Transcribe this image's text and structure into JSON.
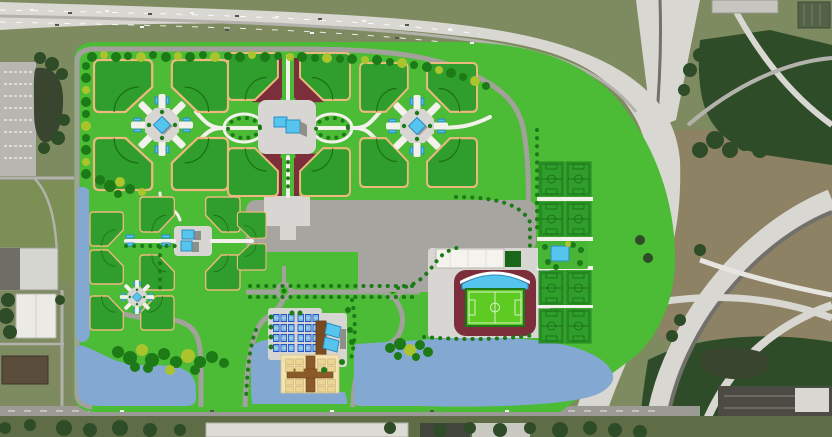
{
  "meta": {
    "view": "aerial-site-plan-rendering",
    "subject": "sports-complex-master-plan",
    "no_visible_text": true
  },
  "colors": {
    "aerial_olive": "#7e8a5f",
    "aerial_grass": "#7c9055",
    "aerial_tree": "#2f4c28",
    "scrub": "#8d8263",
    "highway_light": "#d8d7d2",
    "highway_mid": "#b3b2ac",
    "asphalt": "#71706a",
    "warehouse": "#d6d6d0",
    "pond_dark": "#39452f",
    "site_green": "#4cbb35",
    "field_green": "#2f9e2c",
    "field_border": "#eeb97f",
    "field_line": "#145c10",
    "road_gray": "#a2a19c",
    "parking_gray": "#a6a5a0",
    "plaza_gray": "#d7d6d2",
    "path_white": "#f2f1ec",
    "maroon": "#7c2f3a",
    "pond_blue": "#83a9d2",
    "building_blue": "#56c5ee",
    "building_blue_dark": "#2c8cc0",
    "shadow_gray": "#8f8f8a",
    "stadium_pitch": "#5ecb22",
    "white_bldg": "#f4f3ee",
    "tan_pad": "#f3e2b2",
    "cabana_tan": "#ead592",
    "cabana_line": "#c9ae74",
    "brown": "#8a5a28",
    "hotel_brown": "#7a4a22",
    "court_blue": "#2a52c8",
    "court_inner": "#7fc0e8",
    "tree_dark": "#1c7a17",
    "tree_lime": "#a9c42d"
  },
  "features": {
    "counts": {
      "diamond_field_clusters": 4,
      "diamond_fields": 22,
      "rectangular_pitches": 8,
      "stadium": 1,
      "courts": 24,
      "cabanas": 16,
      "roundabouts": 2,
      "ponds": 4
    },
    "instances": [
      {
        "symbol": "sym-ballfield",
        "layer": "layer-ballfields",
        "name": "ball-field",
        "transforms": [
          "translate(94,60) scale(1.12,1.13)",
          "translate(228,60) scale(-1.08,1.13)",
          "translate(94,190) scale(1.12,-1.13)",
          "translate(228,190) scale(-1.08,-1.13)",
          "translate(228,53) scale(0.96,1.02)",
          "translate(350,53) scale(-0.96,1.02)",
          "translate(228,196) scale(0.96,-1.04)",
          "translate(350,196) scale(-0.96,-1.04)",
          "translate(360,63) scale(0.92,1.06)",
          "translate(477,63) scale(-0.96,1.06)",
          "translate(360,187) scale(0.92,-1.06)",
          "translate(477,187) scale(-0.96,-1.06)",
          "translate(140,197) scale(0.66,0.76)",
          "translate(240,197) scale(-0.66,0.76)",
          "translate(90,212) scale(0.64,0.74)",
          "translate(90,284) scale(0.64,-0.74)",
          "translate(140,290) scale(0.66,-0.76)",
          "translate(240,290) scale(-0.66,-0.76)",
          "translate(266,212) scale(-0.55,0.57)",
          "translate(266,270) scale(-0.55,-0.57)",
          "translate(90,330) scale(0.64,-0.74)",
          "translate(174,330) scale(-0.64,-0.74)"
        ]
      },
      {
        "symbol": "sym-quadplaza",
        "layer": "layer-plazas",
        "name": "field-cluster-plaza",
        "transforms": [
          "translate(162,125)",
          "translate(417,126)",
          "translate(137,297) scale(0.55)"
        ]
      },
      {
        "symbol": "sym-pitch",
        "layer": "layer-pitches",
        "name": "soccer-pitch",
        "transforms": [
          "translate(539,162)",
          "translate(566,162)",
          "translate(539,202)",
          "translate(566,202)",
          "translate(539,271)",
          "translate(566,271)",
          "translate(539,309)",
          "translate(566,309)"
        ]
      },
      {
        "symbol": "sym-court",
        "layer": "layer-courts",
        "name": "tennis-court",
        "transforms": [
          "translate(273,314)",
          "translate(280.5,314)",
          "translate(288,314)",
          "translate(297.5,314)",
          "translate(305,314)",
          "translate(312.5,314)",
          "translate(273,324)",
          "translate(280.5,324)",
          "translate(288,324)",
          "translate(297.5,324)",
          "translate(305,324)",
          "translate(312.5,324)",
          "translate(273,334)",
          "translate(280.5,334)",
          "translate(288,334)",
          "translate(297.5,334)",
          "translate(305,334)",
          "translate(312.5,334)",
          "translate(273,344)",
          "translate(280.5,344)",
          "translate(288,344)",
          "translate(297.5,344)",
          "translate(305,344)",
          "translate(312.5,344)"
        ]
      },
      {
        "symbol": "sym-cabana",
        "layer": "layer-cabanas",
        "name": "cabana",
        "transforms": [
          "translate(285.5,359)",
          "translate(295.5,359)",
          "translate(285.5,366)",
          "translate(295.5,366)",
          "translate(317.5,359)",
          "translate(327.5,359)",
          "translate(317.5,366)",
          "translate(327.5,366)",
          "translate(285.5,379.5)",
          "translate(295.5,379.5)",
          "translate(285.5,386.5)",
          "translate(295.5,386.5)",
          "translate(317.5,379.5)",
          "translate(327.5,379.5)",
          "translate(317.5,386.5)",
          "translate(327.5,386.5)"
        ]
      }
    ],
    "trees": [
      [
        92,
        57,
        5,
        0
      ],
      [
        104,
        55,
        4,
        1
      ],
      [
        116,
        57,
        5,
        0
      ],
      [
        128,
        56,
        4,
        0
      ],
      [
        141,
        57,
        5,
        1
      ],
      [
        153,
        55,
        4,
        0
      ],
      [
        166,
        57,
        5,
        0
      ],
      [
        178,
        56,
        4,
        1
      ],
      [
        190,
        57,
        5,
        0
      ],
      [
        203,
        55,
        4,
        0
      ],
      [
        215,
        57,
        5,
        1
      ],
      [
        228,
        56,
        4,
        0
      ],
      [
        240,
        57,
        5,
        0
      ],
      [
        252,
        55,
        4,
        1
      ],
      [
        265,
        57,
        5,
        0
      ],
      [
        278,
        56,
        4,
        0
      ],
      [
        290,
        57,
        4,
        1
      ],
      [
        302,
        57,
        5,
        0
      ],
      [
        315,
        58,
        4,
        0
      ],
      [
        327,
        58,
        5,
        1
      ],
      [
        340,
        59,
        4,
        0
      ],
      [
        352,
        59,
        5,
        0
      ],
      [
        365,
        60,
        4,
        1
      ],
      [
        377,
        60,
        5,
        0
      ],
      [
        390,
        62,
        4,
        0
      ],
      [
        402,
        63,
        5,
        1
      ],
      [
        414,
        65,
        4,
        0
      ],
      [
        427,
        67,
        5,
        0
      ],
      [
        439,
        70,
        4,
        1
      ],
      [
        451,
        73,
        5,
        0
      ],
      [
        463,
        77,
        4,
        0
      ],
      [
        475,
        81,
        5,
        1
      ],
      [
        486,
        86,
        4,
        0
      ],
      [
        86,
        66,
        4,
        0
      ],
      [
        86,
        78,
        5,
        0
      ],
      [
        86,
        90,
        4,
        1
      ],
      [
        86,
        102,
        5,
        0
      ],
      [
        86,
        114,
        4,
        0
      ],
      [
        86,
        126,
        5,
        1
      ],
      [
        86,
        138,
        4,
        0
      ],
      [
        86,
        150,
        5,
        0
      ],
      [
        86,
        162,
        4,
        1
      ],
      [
        86,
        174,
        5,
        0
      ],
      [
        100,
        180,
        5,
        0
      ],
      [
        110,
        186,
        6,
        0
      ],
      [
        120,
        182,
        5,
        1
      ],
      [
        130,
        189,
        5,
        0
      ],
      [
        118,
        194,
        4,
        0
      ],
      [
        142,
        192,
        4,
        1
      ],
      [
        118,
        352,
        6,
        0
      ],
      [
        130,
        358,
        7,
        0
      ],
      [
        142,
        350,
        6,
        1
      ],
      [
        152,
        360,
        7,
        0
      ],
      [
        164,
        354,
        6,
        0
      ],
      [
        176,
        362,
        6,
        0
      ],
      [
        188,
        356,
        7,
        1
      ],
      [
        200,
        362,
        6,
        0
      ],
      [
        212,
        357,
        6,
        0
      ],
      [
        224,
        363,
        5,
        0
      ],
      [
        148,
        368,
        5,
        0
      ],
      [
        170,
        370,
        5,
        1
      ],
      [
        195,
        370,
        5,
        0
      ],
      [
        135,
        367,
        5,
        0
      ],
      [
        390,
        348,
        5,
        0
      ],
      [
        400,
        344,
        6,
        0
      ],
      [
        410,
        350,
        6,
        1
      ],
      [
        420,
        345,
        5,
        0
      ],
      [
        428,
        352,
        5,
        0
      ],
      [
        398,
        356,
        4,
        0
      ],
      [
        416,
        357,
        4,
        0
      ],
      [
        545,
        247,
        3,
        0
      ],
      [
        548,
        262,
        3,
        0
      ],
      [
        556,
        267,
        3,
        0
      ],
      [
        573,
        245,
        3,
        0
      ],
      [
        581,
        250,
        3,
        0
      ],
      [
        580,
        263,
        3,
        0
      ],
      [
        568,
        244,
        3,
        1
      ],
      [
        271,
        317,
        2.5,
        0
      ],
      [
        271,
        327,
        2.5,
        0
      ],
      [
        271,
        337,
        2.5,
        0
      ],
      [
        271,
        347,
        2.5,
        0
      ],
      [
        292,
        313,
        2.5,
        0
      ],
      [
        300,
        313,
        2.5,
        0
      ],
      [
        324,
        370,
        3,
        0
      ],
      [
        342,
        362,
        3,
        0
      ],
      [
        350,
        330,
        3,
        0
      ],
      [
        352,
        342,
        3,
        0
      ],
      [
        348,
        310,
        3,
        0
      ],
      [
        40,
        58,
        6,
        2
      ],
      [
        52,
        64,
        7,
        2
      ],
      [
        62,
        74,
        6,
        2
      ],
      [
        64,
        120,
        6,
        2
      ],
      [
        58,
        138,
        7,
        2
      ],
      [
        44,
        148,
        6,
        2
      ],
      [
        8,
        300,
        7,
        2
      ],
      [
        6,
        316,
        8,
        2
      ],
      [
        10,
        332,
        7,
        2
      ],
      [
        60,
        300,
        5,
        2
      ],
      [
        64,
        428,
        8,
        2
      ],
      [
        90,
        430,
        7,
        2
      ],
      [
        120,
        428,
        8,
        2
      ],
      [
        150,
        430,
        7,
        2
      ],
      [
        180,
        430,
        6,
        2
      ],
      [
        390,
        428,
        6,
        2
      ],
      [
        440,
        430,
        7,
        2
      ],
      [
        470,
        428,
        6,
        2
      ],
      [
        500,
        430,
        7,
        2
      ],
      [
        530,
        428,
        6,
        2
      ],
      [
        560,
        430,
        8,
        2
      ],
      [
        590,
        428,
        7,
        2
      ],
      [
        615,
        430,
        7,
        2
      ],
      [
        640,
        432,
        7,
        2
      ],
      [
        30,
        425,
        6,
        2
      ],
      [
        5,
        428,
        6,
        2
      ],
      [
        700,
        150,
        8,
        2
      ],
      [
        715,
        140,
        9,
        2
      ],
      [
        730,
        150,
        8,
        2
      ],
      [
        745,
        142,
        9,
        2
      ],
      [
        760,
        150,
        8,
        2
      ],
      [
        700,
        55,
        7,
        2
      ],
      [
        690,
        70,
        7,
        2
      ],
      [
        684,
        90,
        6,
        2
      ],
      [
        700,
        250,
        6,
        2
      ],
      [
        640,
        240,
        5,
        2
      ],
      [
        648,
        258,
        5,
        2
      ],
      [
        680,
        320,
        6,
        2
      ],
      [
        672,
        336,
        6,
        2
      ]
    ],
    "vehicles": [
      [
        30,
        9,
        0
      ],
      [
        68,
        12,
        1
      ],
      [
        105,
        10,
        0
      ],
      [
        148,
        13,
        1
      ],
      [
        190,
        12,
        0
      ],
      [
        235,
        15,
        1
      ],
      [
        275,
        16,
        0
      ],
      [
        318,
        18,
        1
      ],
      [
        362,
        20,
        0
      ],
      [
        405,
        24,
        1
      ],
      [
        448,
        28,
        0
      ],
      [
        55,
        24,
        1
      ],
      [
        140,
        26,
        0
      ],
      [
        225,
        29,
        1
      ],
      [
        310,
        32,
        0
      ],
      [
        395,
        37,
        1
      ],
      [
        470,
        42,
        0
      ],
      [
        120,
        410,
        0
      ],
      [
        210,
        410,
        1
      ],
      [
        330,
        410,
        0
      ],
      [
        430,
        410,
        1
      ],
      [
        505,
        410,
        0
      ]
    ]
  }
}
